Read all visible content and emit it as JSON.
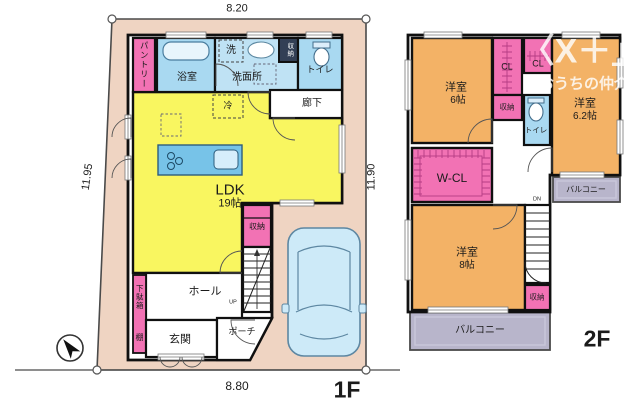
{
  "watermark": {
    "logo": "〈X＋」",
    "brand": "おうちの仲介"
  },
  "floor1": {
    "name": "1F",
    "dims": {
      "top": "8.20",
      "left": "11.95",
      "right": "11.90",
      "bottom": "8.80"
    },
    "labels": {
      "pantry": "パントリー",
      "bath": "浴室",
      "laundry": "洗",
      "washroom": "洗面所",
      "storage_top": "収納",
      "toilet": "トイレ",
      "corridor": "廊下",
      "fridge": "冷",
      "ldk": "LDK",
      "ldk_size": "19帖",
      "stair_storage": "収納",
      "up": "UP",
      "hall": "ホール",
      "shoe_cabinet": "下駄箱",
      "shelf": "棚",
      "entrance": "玄関",
      "porch": "ポーチ"
    }
  },
  "floor2": {
    "name": "2F",
    "labels": {
      "room6": "洋室",
      "room6_size": "6帖",
      "cl_left": "CL",
      "cl_right": "CL",
      "storage_mid": "収納",
      "toilet": "トイレ",
      "room62": "洋室",
      "room62_size": "6.2帖",
      "wcl": "W-CL",
      "dn": "DN",
      "room8": "洋室",
      "room8_size": "8帖",
      "storage_bottom": "収納",
      "balcony_right": "バルコニー",
      "balcony_bottom": "バルコニー"
    }
  },
  "colors": {
    "lot": "#efd4c2",
    "ldk": "#f9f660",
    "room_orange": "#f3b266",
    "wet_blue": "#a9d9f1",
    "closet_pink": "#f272b4",
    "balcony": "#b8b5cb",
    "car": "#cdeaf8",
    "wall": "#101010"
  }
}
